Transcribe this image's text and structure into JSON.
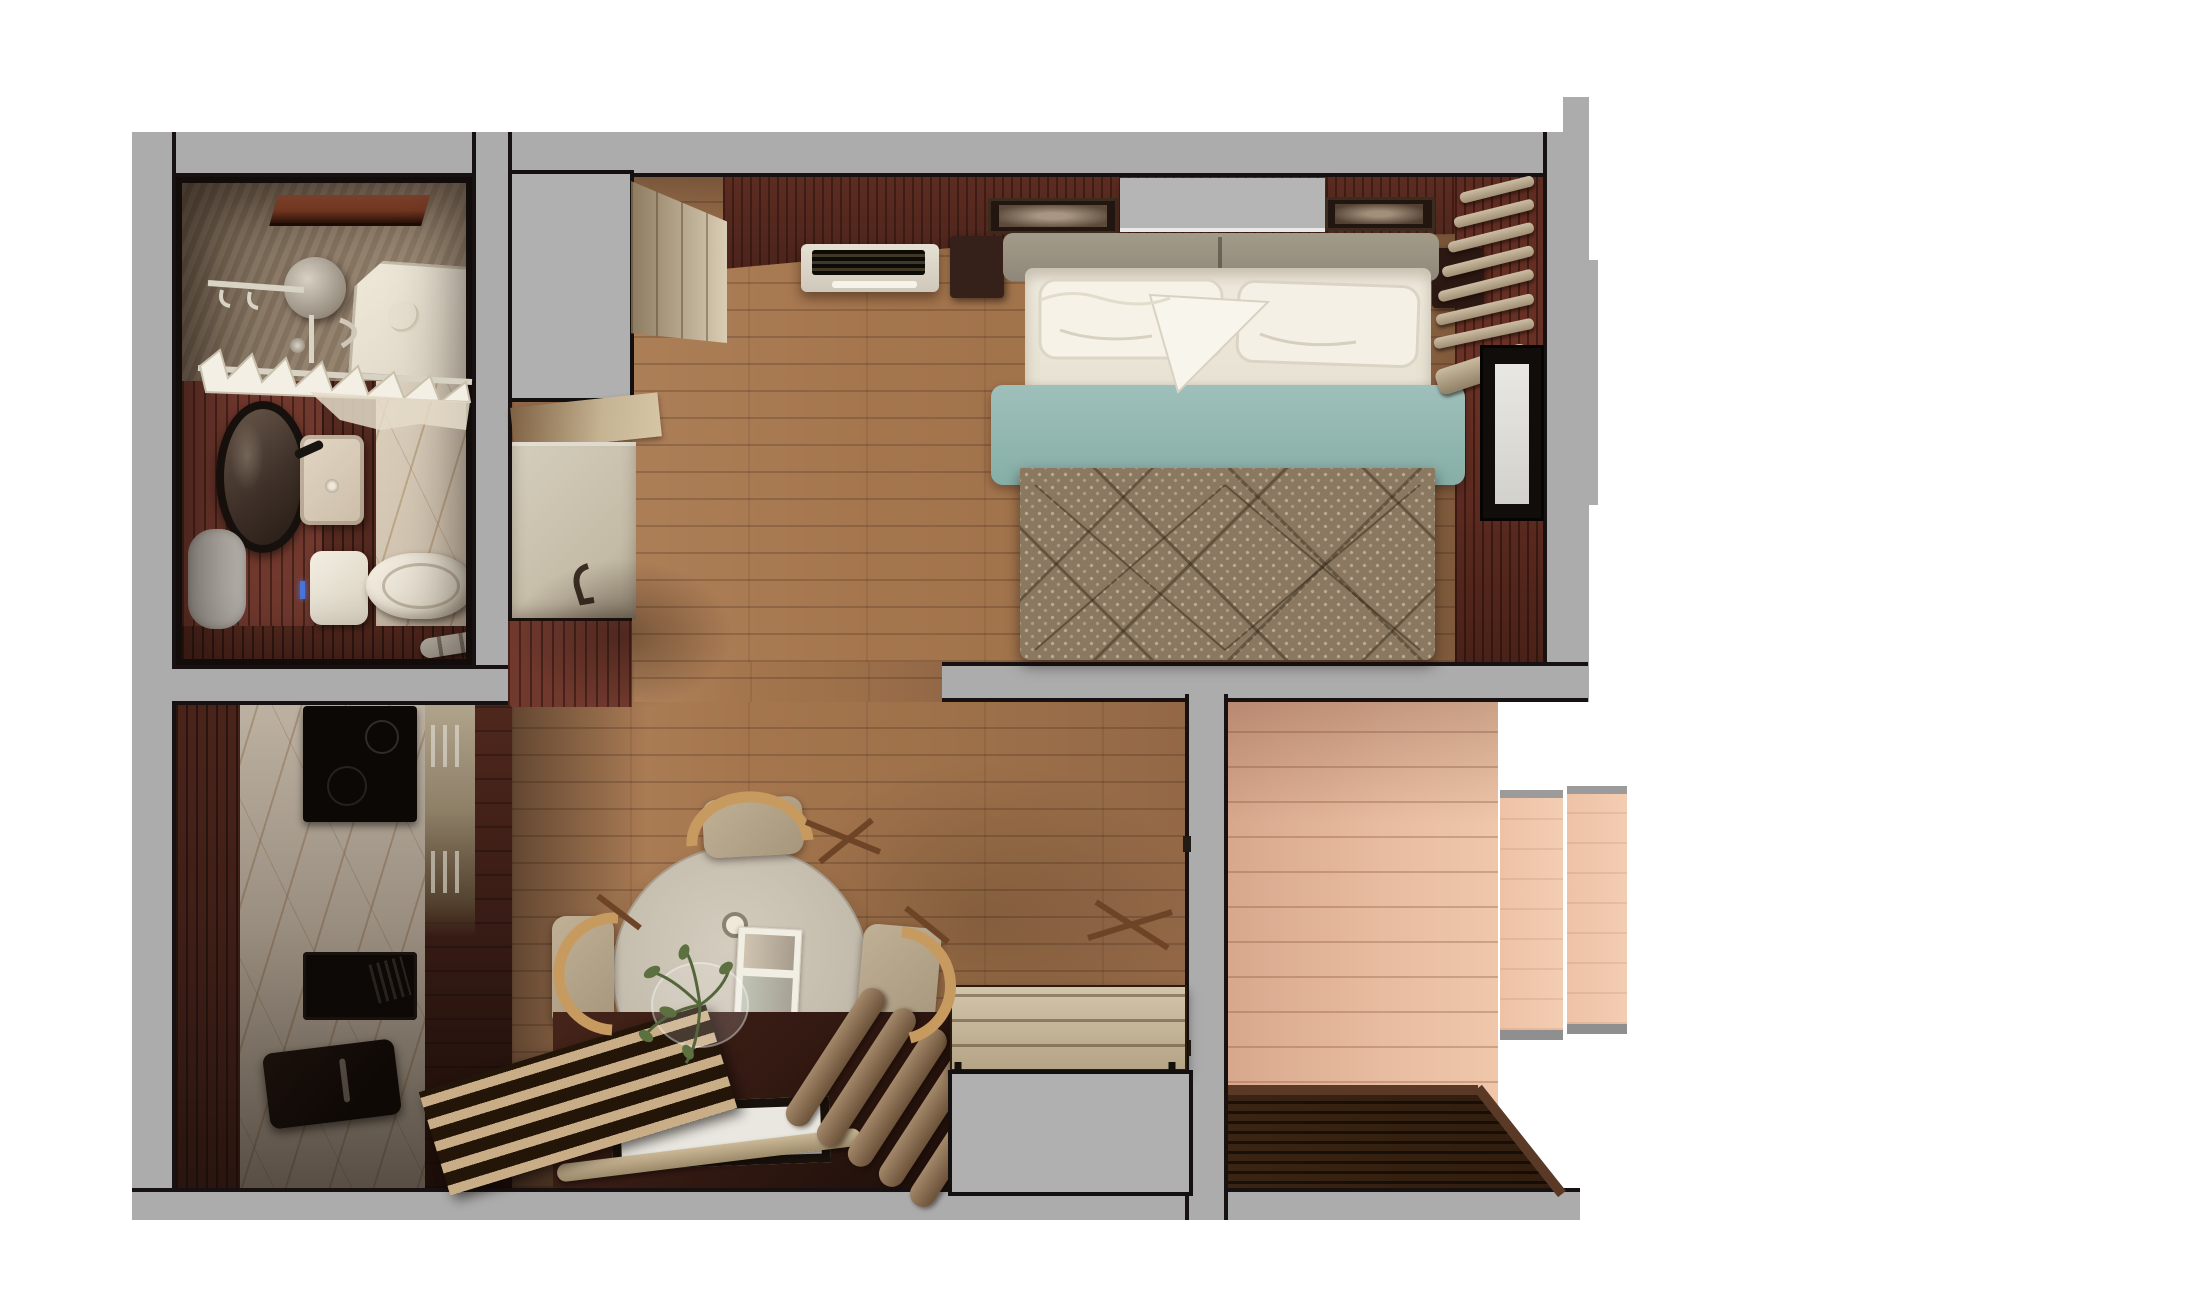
{
  "scene": {
    "kind": "photorealistic top-down floor plan render",
    "view": "top-down",
    "background": "#ffffff",
    "no_visible_text": true
  },
  "palette": {
    "wall_gray": "#acacac",
    "outline_black": "#171111",
    "wood_floor": "#a5764e",
    "kitchen_floor": "#4a241c",
    "balcony_floor": "#e7bb9f",
    "deck_brown": "#33200f",
    "slat_wall_red": "#71392e",
    "maroon_wall": "#542a20",
    "marble": "#d5c8b7",
    "teal_throw": "#8fb7b0",
    "bedspread": "#8a7960",
    "table_top": "#c9c1b2",
    "chair_wood": "#c79a60",
    "cushion": "#b6a68c",
    "panel_pink": "#eec2a6"
  },
  "rooms": {
    "bathroom": {
      "label": "Bathroom",
      "furniture": [
        "skylight",
        "shower head",
        "shower tray",
        "towel rail with towels",
        "round mirror",
        "washbasin",
        "toilet",
        "bath mat",
        "chrome holder",
        "marble wall",
        "red slatted wall"
      ]
    },
    "entry": {
      "label": "Entry hall",
      "furniture": [
        "tall gray cabinet",
        "side counter",
        "appliance front with handle",
        "red slatted wall block"
      ]
    },
    "bedroom": {
      "label": "Bedroom",
      "furniture": [
        "double bed",
        "pillows",
        "teal throw",
        "patterned bedspread",
        "headboard",
        "left nightstand",
        "right nightstand",
        "wall art left",
        "wall art right",
        "floating shelf",
        "air conditioner",
        "wardrobe",
        "roman blinds",
        "window"
      ]
    },
    "kitchen": {
      "label": "Kitchen",
      "furniture": [
        "marble counter",
        "induction cooktop",
        "black sink",
        "kettle",
        "cabinet fronts with handles"
      ]
    },
    "living": {
      "label": "Living / dining room",
      "furniture": [
        "round dining table",
        "magazine",
        "glass plate with plant",
        "cup",
        "dining chair top",
        "dining chair left",
        "dining chair right",
        "floor platform",
        "white mat",
        "slatted bench",
        "floor cushion rolls",
        "wooden bench",
        "gray cabinet",
        "wood tile patch"
      ]
    },
    "balcony": {
      "label": "Balcony",
      "furniture": [
        "plank floor",
        "dark wood deck",
        "fold-out outdoor table (two panels)"
      ]
    }
  }
}
